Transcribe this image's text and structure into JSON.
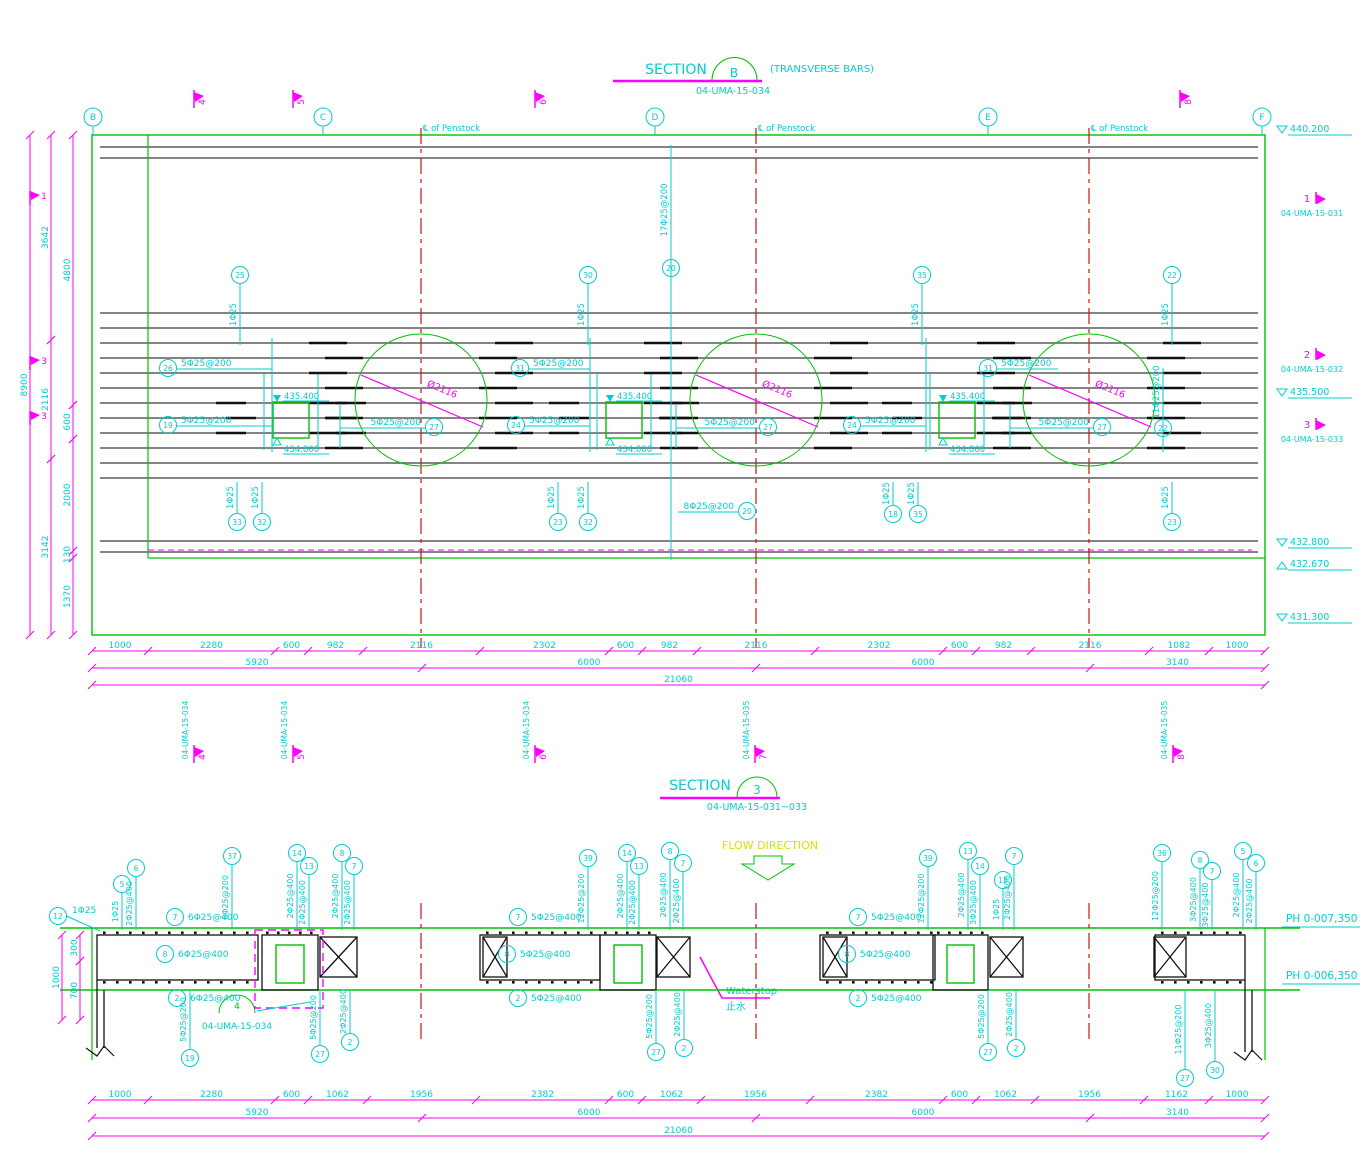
{
  "colors": {
    "cyan": "#00CFCF",
    "magenta": "#FF00FF",
    "green": "#00C300",
    "red": "#C81414",
    "yellow": "#DEDE00",
    "gray": "#5C5C5C",
    "black": "#111111"
  },
  "drawing": {
    "section_b": {
      "title": "SECTION",
      "bubble": "B",
      "suffix": "(TRANSVERSE BARS)",
      "dwg_no": "04-UMA-15-034"
    },
    "section_3": {
      "title": "SECTION",
      "bubble": "3",
      "dwg_no": "04-UMA-15-031~033"
    },
    "flow_direction": "FLOW DIRECTION",
    "waterstop_en": "Waterstop",
    "waterstop_zh": "止水"
  },
  "top_plan": {
    "centerline_label": "℄ of Penstock",
    "dia_label": "Ø2116",
    "square_elev_top": "435.400",
    "square_elev_bot": "434.800",
    "grids": [
      {
        "label": "B",
        "x": 93
      },
      {
        "label": "C",
        "x": 323
      },
      {
        "label": "D",
        "x": 655
      },
      {
        "label": "E",
        "x": 988
      },
      {
        "label": "F",
        "x": 1262
      }
    ],
    "circles": [
      {
        "cx": 421
      },
      {
        "cx": 756
      },
      {
        "cx": 1089
      }
    ],
    "squares": [
      {
        "cx": 291
      },
      {
        "cx": 624
      },
      {
        "cx": 957
      }
    ],
    "flags_top": [
      {
        "num": "4",
        "x": 194
      },
      {
        "num": "5",
        "x": 293
      },
      {
        "num": "6",
        "x": 535
      },
      {
        "num": "8",
        "x": 1180
      }
    ],
    "flags_left": [
      {
        "num": "1",
        "y": 197
      },
      {
        "num": "3",
        "y": 362
      },
      {
        "num": "3",
        "y": 417
      }
    ],
    "refs_right": [
      {
        "num": "1",
        "dwg": "04-UMA-15-031",
        "y": 202
      },
      {
        "num": "2",
        "dwg": "04-UMA-15-032",
        "y": 358
      },
      {
        "num": "3",
        "dwg": "04-UMA-15-033",
        "y": 428
      }
    ],
    "flags_below": [
      {
        "num": "4",
        "dwg": "04-UMA-15-034",
        "x": 194
      },
      {
        "num": "5",
        "dwg": "04-UMA-15-034",
        "x": 293
      },
      {
        "num": "6",
        "dwg": "04-UMA-15-034",
        "x": 535
      },
      {
        "num": "7",
        "dwg": "04-UMA-15-035",
        "x": 755
      },
      {
        "num": "8",
        "dwg": "04-UMA-15-035",
        "x": 1173
      }
    ],
    "elev_right": [
      {
        "label": "440.200",
        "y": 133,
        "dir": "down"
      },
      {
        "label": "435.500",
        "y": 396,
        "dir": "down"
      },
      {
        "label": "432.800",
        "y": 546,
        "dir": "down"
      },
      {
        "label": "432.670",
        "y": 562,
        "dir": "up"
      },
      {
        "label": "431.300",
        "y": 621,
        "dir": "down"
      }
    ],
    "callouts_h": [
      {
        "num": "26",
        "label": "5Φ25@200",
        "cx": 168,
        "cy": 368,
        "textside": "right",
        "leadto": 272
      },
      {
        "num": "19",
        "label": "5Φ25@200",
        "cx": 168,
        "cy": 425,
        "textside": "right",
        "leadto": 272
      },
      {
        "num": "31",
        "label": "5Φ25@200",
        "cx": 520,
        "cy": 368,
        "textside": "right",
        "leadto": 590
      },
      {
        "num": "24",
        "label": "5Φ25@200",
        "cx": 516,
        "cy": 425,
        "textside": "right",
        "leadto": 590
      },
      {
        "num": "27",
        "label": "5Φ25@200",
        "cx": 434,
        "cy": 427,
        "textside": "left",
        "leadto": 340
      },
      {
        "num": "27",
        "label": "5Φ25@200",
        "cx": 768,
        "cy": 427,
        "textside": "left",
        "leadto": 676
      },
      {
        "num": "24",
        "label": "5Φ25@200",
        "cx": 852,
        "cy": 425,
        "textside": "right",
        "leadto": 926
      },
      {
        "num": "31",
        "label": "5Φ25@200",
        "cx": 988,
        "cy": 368,
        "textside": "right",
        "leadto": 1058
      },
      {
        "num": "27",
        "label": "5Φ25@200",
        "cx": 1102,
        "cy": 427,
        "textside": "left",
        "leadto": 1010
      },
      {
        "num": "20",
        "label": "8Φ25@200",
        "cx": 747,
        "cy": 511,
        "textside": "left",
        "leadto": 678
      }
    ],
    "callouts_v_top": [
      {
        "num": "25",
        "label": "1Φ25",
        "x": 240,
        "cy": 275
      },
      {
        "num": "30",
        "label": "1Φ25",
        "x": 588,
        "cy": 275
      },
      {
        "num": "35",
        "label": "1Φ25",
        "x": 922,
        "cy": 275
      },
      {
        "num": "22",
        "label": "1Φ25",
        "x": 1172,
        "cy": 275
      }
    ],
    "callouts_v_special": [
      {
        "num": "20",
        "label": "17Φ25@200",
        "x": 671,
        "cy": 268,
        "y1": 145,
        "y2": 560,
        "labely": 210
      },
      {
        "num": "22",
        "label": "11Φ25@200",
        "x": 1163,
        "cy": 428,
        "y1": 368,
        "y2": 452,
        "labely": 392
      }
    ],
    "callouts_v_bot": [
      {
        "num": "33",
        "label": "1Φ25",
        "x": 237,
        "cy": 522
      },
      {
        "num": "32",
        "label": "1Φ25",
        "x": 262,
        "cy": 522
      },
      {
        "num": "23",
        "label": "1Φ25",
        "x": 558,
        "cy": 522
      },
      {
        "num": "32",
        "label": "1Φ25",
        "x": 588,
        "cy": 522
      },
      {
        "num": "18",
        "label": "1Φ25",
        "x": 893,
        "cy": 514
      },
      {
        "num": "35",
        "label": "1Φ25",
        "x": 918,
        "cy": 514
      },
      {
        "num": "23",
        "label": "1Φ25",
        "x": 1172,
        "cy": 522
      }
    ],
    "vdims": [
      {
        "x": 30,
        "segs": [
          {
            "label": "8900",
            "y1": 135,
            "y2": 635
          }
        ]
      },
      {
        "x": 51,
        "segs": [
          {
            "label": "3642",
            "y1": 135,
            "y2": 340
          },
          {
            "label": "2116",
            "y1": 340,
            "y2": 459
          },
          {
            "label": "3142",
            "y1": 459,
            "y2": 635
          }
        ]
      },
      {
        "x": 73,
        "segs": [
          {
            "label": "4800",
            "y1": 135,
            "y2": 405
          },
          {
            "label": "600",
            "y1": 405,
            "y2": 439
          },
          {
            "label": "2000",
            "y1": 439,
            "y2": 551
          },
          {
            "label": "130",
            "y1": 551,
            "y2": 558
          },
          {
            "label": "1370",
            "y1": 558,
            "y2": 635
          }
        ]
      }
    ],
    "hdims": [
      {
        "y": 651,
        "bounds": [
          92,
          148,
          275,
          308,
          363,
          480,
          609,
          642,
          697,
          815,
          943,
          976,
          1031,
          1149,
          1209,
          1265
        ],
        "labels": [
          "1000",
          "2280",
          "600",
          "982",
          "2116",
          "2302",
          "600",
          "982",
          "2116",
          "2302",
          "600",
          "982",
          "2116",
          "1082",
          "1000"
        ]
      },
      {
        "y": 668,
        "bounds": [
          92,
          422,
          756,
          1090,
          1265
        ],
        "labels": [
          "5920",
          "6000",
          "6000",
          "3140"
        ]
      },
      {
        "y": 685,
        "bounds": [
          92,
          1265
        ],
        "labels": [
          "21060"
        ]
      }
    ]
  },
  "bottom_section": {
    "ph_labels": [
      {
        "label": "PH 0-007,350",
        "y": 922
      },
      {
        "label": "PH 0-006,350",
        "y": 979
      }
    ],
    "detail_ref": {
      "num": "4",
      "dwg": "04-UMA-15-034",
      "x": 237,
      "y": 1013
    },
    "left_callout": {
      "num": "12",
      "label": "1Φ25",
      "cx": 58,
      "cy": 916
    },
    "vdims": [
      {
        "x": 62,
        "segs": [
          {
            "label": "1000",
            "y1": 935,
            "y2": 1020
          }
        ]
      },
      {
        "x": 80,
        "segs": [
          {
            "label": "300",
            "y1": 935,
            "y2": 961
          },
          {
            "label": "700",
            "y1": 961,
            "y2": 1020
          }
        ]
      }
    ],
    "callouts_top": [
      {
        "num": "5",
        "label": "1Φ25",
        "x": 122,
        "cy": 884
      },
      {
        "num": "6",
        "label": "2Φ25@400",
        "x": 136,
        "cy": 868
      },
      {
        "num": "37",
        "label": "6Φ25@200",
        "x": 232,
        "cy": 856
      },
      {
        "num": "14",
        "label": "2Φ25@400",
        "x": 297,
        "cy": 853
      },
      {
        "num": "13",
        "label": "2Φ25@400",
        "x": 309,
        "cy": 866
      },
      {
        "num": "8",
        "label": "2Φ25@400",
        "x": 342,
        "cy": 853
      },
      {
        "num": "7",
        "label": "2Φ25@400",
        "x": 354,
        "cy": 866
      },
      {
        "num": "39",
        "label": "12Φ25@200",
        "x": 588,
        "cy": 858
      },
      {
        "num": "14",
        "label": "2Φ25@400",
        "x": 627,
        "cy": 853
      },
      {
        "num": "13",
        "label": "2Φ25@400",
        "x": 639,
        "cy": 866
      },
      {
        "num": "8",
        "label": "2Φ25@400",
        "x": 670,
        "cy": 851
      },
      {
        "num": "7",
        "label": "2Φ25@400",
        "x": 683,
        "cy": 863
      },
      {
        "num": "39",
        "label": "12Φ25@200",
        "x": 928,
        "cy": 858
      },
      {
        "num": "13",
        "label": "2Φ25@400",
        "x": 968,
        "cy": 851
      },
      {
        "num": "14",
        "label": "3Φ25@400",
        "x": 980,
        "cy": 866
      },
      {
        "num": "18",
        "label": "1Φ25",
        "x": 1003,
        "cy": 880
      },
      {
        "num": "7",
        "label": "2Φ25@400",
        "x": 1014,
        "cy": 856
      },
      {
        "num": "36",
        "label": "12Φ25@200",
        "x": 1162,
        "cy": 853
      },
      {
        "num": "8",
        "label": "3Φ25@400",
        "x": 1200,
        "cy": 860
      },
      {
        "num": "7",
        "label": "3Φ25@400",
        "x": 1212,
        "cy": 871
      },
      {
        "num": "5",
        "label": "2Φ25@400",
        "x": 1243,
        "cy": 851
      },
      {
        "num": "6",
        "label": "2Φ25@400",
        "x": 1256,
        "cy": 863
      }
    ],
    "callouts_slab": [
      {
        "num": "7",
        "label": "6Φ25@400",
        "x": 175,
        "y": 917
      },
      {
        "num": "8",
        "label": "6Φ25@400",
        "x": 165,
        "y": 954
      },
      {
        "num": "2",
        "label": "6Φ25@400",
        "x": 177,
        "y": 998
      },
      {
        "num": "7",
        "label": "5Φ25@400",
        "x": 518,
        "y": 917
      },
      {
        "num": "8",
        "label": "5Φ25@400",
        "x": 507,
        "y": 954
      },
      {
        "num": "2",
        "label": "5Φ25@400",
        "x": 518,
        "y": 998
      },
      {
        "num": "7",
        "label": "5Φ25@400",
        "x": 858,
        "y": 917
      },
      {
        "num": "8",
        "label": "5Φ25@400",
        "x": 847,
        "y": 954
      },
      {
        "num": "2",
        "label": "5Φ25@400",
        "x": 858,
        "y": 998
      }
    ],
    "callouts_bot": [
      {
        "num": "19",
        "label": "5Φ25@200",
        "x": 190,
        "cy": 1058
      },
      {
        "num": "27",
        "label": "5Φ25@200",
        "x": 320,
        "cy": 1054
      },
      {
        "num": "2",
        "label": "2Φ25@400",
        "x": 350,
        "cy": 1042
      },
      {
        "num": "27",
        "label": "5Φ25@200",
        "x": 656,
        "cy": 1052
      },
      {
        "num": "2",
        "label": "2Φ25@400",
        "x": 684,
        "cy": 1048
      },
      {
        "num": "27",
        "label": "5Φ25@200",
        "x": 988,
        "cy": 1052
      },
      {
        "num": "2",
        "label": "2Φ25@400",
        "x": 1016,
        "cy": 1048
      },
      {
        "num": "27",
        "label": "11Φ25@200",
        "x": 1185,
        "cy": 1078
      },
      {
        "num": "30",
        "label": "3Φ25@400",
        "x": 1215,
        "cy": 1070
      }
    ],
    "hdims": [
      {
        "y": 1100,
        "bounds": [
          92,
          148,
          275,
          308,
          367,
          476,
          609,
          642,
          701,
          810,
          943,
          976,
          1035,
          1144,
          1209,
          1265
        ],
        "labels": [
          "1000",
          "2280",
          "600",
          "1062",
          "1956",
          "2382",
          "600",
          "1062",
          "1956",
          "2382",
          "600",
          "1062",
          "1956",
          "1162",
          "1000"
        ]
      },
      {
        "y": 1118,
        "bounds": [
          92,
          422,
          756,
          1090,
          1265
        ],
        "labels": [
          "5920",
          "6000",
          "6000",
          "3140"
        ]
      },
      {
        "y": 1136,
        "bounds": [
          92,
          1265
        ],
        "labels": [
          "21060"
        ]
      }
    ]
  }
}
